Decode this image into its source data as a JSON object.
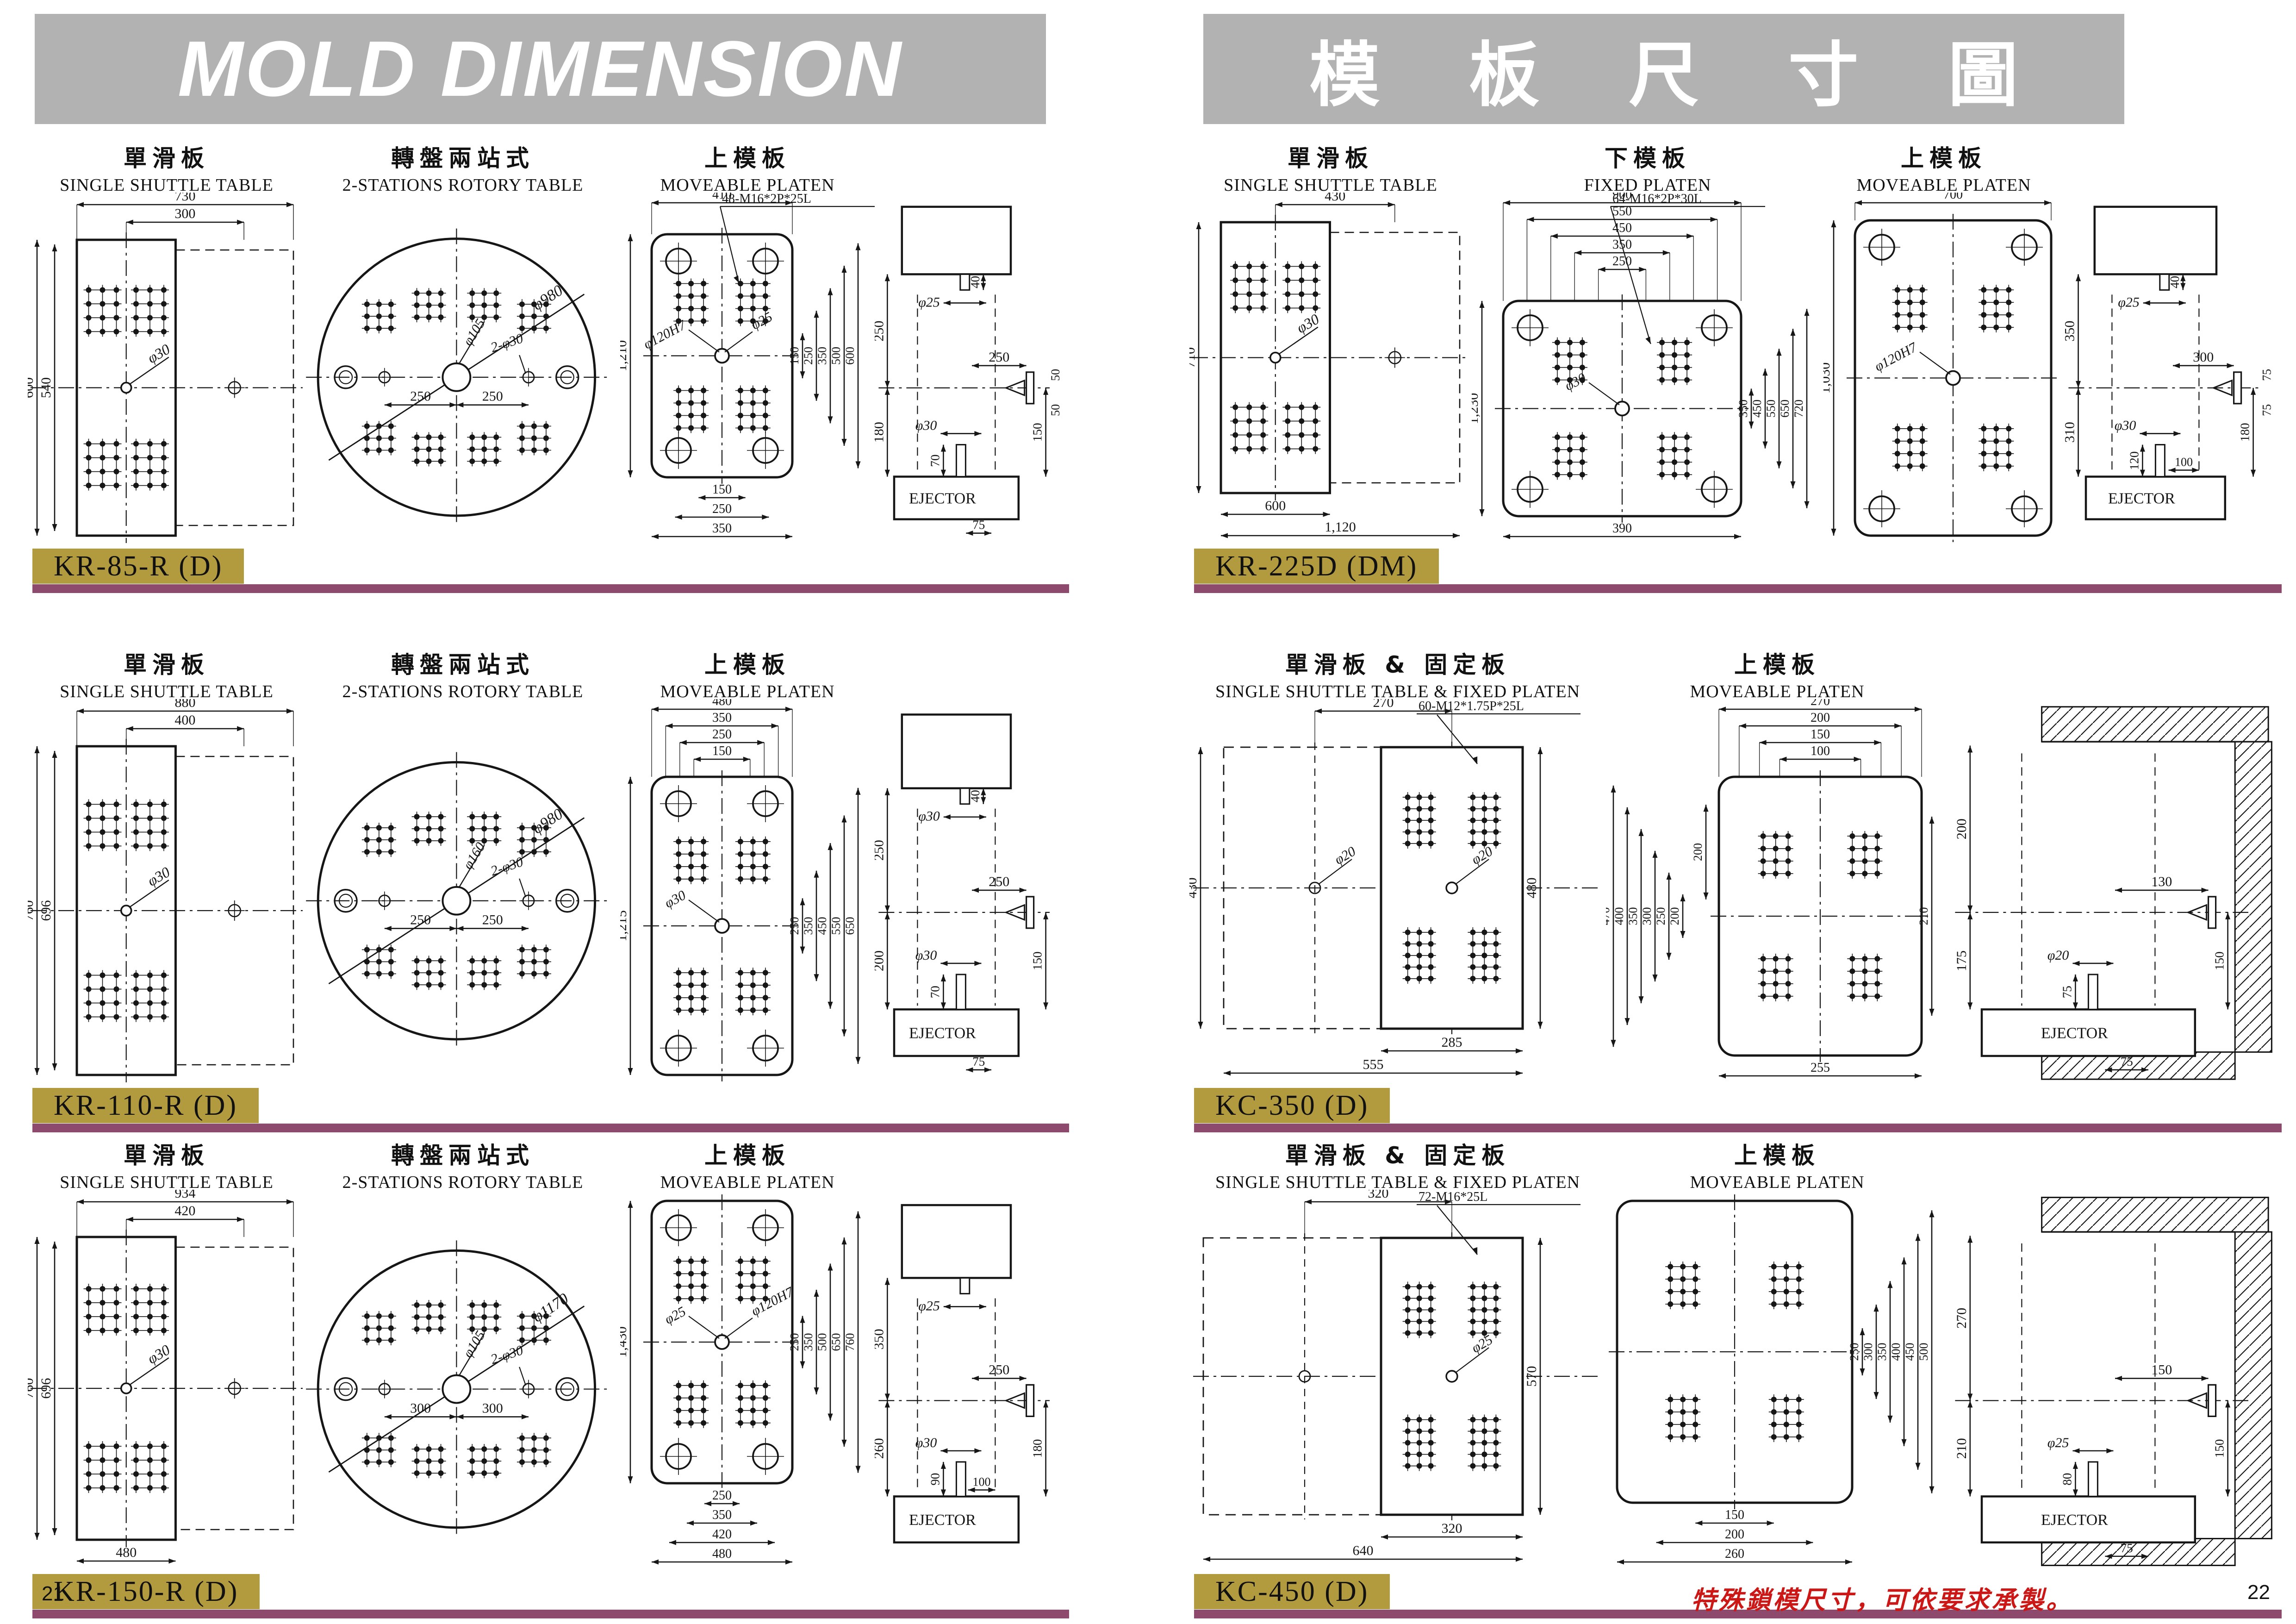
{
  "titles": {
    "left": "MOLD DIMENSION",
    "right": "模 板 尺 寸 圖"
  },
  "footer": {
    "left_page": "21",
    "right_page": "22",
    "note": "特殊鎖模尺寸，可依要求承製。"
  },
  "colors": {
    "header_bg": "#b2b2b2",
    "badge_bg": "#b29a3e",
    "bar": "#8d4a6d",
    "note_red": "#cc1717",
    "ink": "#161616"
  },
  "sections": [
    {
      "model": "KR-85-R (D)",
      "columns": [
        {
          "zh": "單滑板",
          "en": "SINGLE SHUTTLE TABLE"
        },
        {
          "zh": "轉盤兩站式",
          "en": "2-STATIONS ROTORY TABLE"
        },
        {
          "zh": "上模板",
          "en": "MOVEABLE PLATEN"
        }
      ],
      "drawings": [
        {
          "kind": "shuttle",
          "top": [
            "730",
            "300"
          ],
          "left": [
            "600",
            "540"
          ],
          "bottom": [],
          "center": "φ30"
        },
        {
          "kind": "rotary",
          "diameter": "φ980",
          "center": "φ105",
          "holes": "2-φ30",
          "spacing": [
            "250",
            "250"
          ]
        },
        {
          "kind": "platen",
          "top": [
            "410"
          ],
          "note": "48-M16*2P*25L",
          "height": "1,210",
          "center": [
            "φ120H7",
            "φ25"
          ],
          "right": [
            "150",
            "250",
            "350",
            "500",
            "600"
          ],
          "bottom": [
            "150",
            "250",
            "350"
          ]
        },
        {
          "kind": "side",
          "top": "40",
          "stem_top": "φ25",
          "left_top": "250",
          "left_bottom": "180",
          "stem_bottom": "φ30",
          "stem_h": "70",
          "nozzle_x": "250",
          "nozzle_y": "150",
          "pair": [
            "50",
            "50"
          ],
          "ejector": "EJECTOR",
          "foot": "75"
        }
      ]
    },
    {
      "model": "KR-110-R (D)",
      "columns": [
        {
          "zh": "單滑板",
          "en": "SINGLE SHUTTLE TABLE"
        },
        {
          "zh": "轉盤兩站式",
          "en": "2-STATIONS ROTORY TABLE"
        },
        {
          "zh": "上模板",
          "en": "MOVEABLE PLATEN"
        }
      ],
      "drawings": [
        {
          "kind": "shuttle",
          "top": [
            "880",
            "400"
          ],
          "left": [
            "760",
            "696"
          ],
          "bottom": [],
          "center": "φ30"
        },
        {
          "kind": "rotary",
          "diameter": "φ980",
          "center": "φ160",
          "holes": "2-φ30",
          "spacing": [
            "250",
            "250"
          ]
        },
        {
          "kind": "platen",
          "top": [
            "480",
            "350",
            "250",
            "150"
          ],
          "height": "1,215",
          "center": [
            "φ30"
          ],
          "right": [
            "250",
            "350",
            "450",
            "550",
            "650"
          ],
          "bottom": []
        },
        {
          "kind": "side",
          "top": "40",
          "stem_top": "φ30",
          "left_top": "250",
          "left_bottom": "200",
          "stem_bottom": "φ30",
          "stem_h": "70",
          "nozzle_x": "250",
          "nozzle_y": "150",
          "ejector": "EJECTOR",
          "foot": "75"
        }
      ]
    },
    {
      "model": "KR-150-R (D)",
      "columns": [
        {
          "zh": "單滑板",
          "en": "SINGLE SHUTTLE TABLE"
        },
        {
          "zh": "轉盤兩站式",
          "en": "2-STATIONS ROTORY TABLE"
        },
        {
          "zh": "上模板",
          "en": "MOVEABLE PLATEN"
        }
      ],
      "drawings": [
        {
          "kind": "shuttle",
          "top": [
            "934",
            "420"
          ],
          "left": [
            "760",
            "696"
          ],
          "bottom": [
            "480"
          ],
          "center": "φ30"
        },
        {
          "kind": "rotary",
          "diameter": "φ1170",
          "center": "φ105",
          "holes": "2-φ30",
          "spacing": [
            "300",
            "300"
          ]
        },
        {
          "kind": "platen",
          "top": [],
          "height": "1,430",
          "center": [
            "φ25",
            "φ120H7"
          ],
          "right": [
            "250",
            "350",
            "500",
            "650",
            "760"
          ],
          "bottom": [
            "250",
            "350",
            "420",
            "480"
          ]
        },
        {
          "kind": "side",
          "stem_top": "φ25",
          "left_top": "350",
          "left_bottom": "260",
          "stem_bottom": "φ30",
          "stem_h": "90",
          "inner": "100",
          "nozzle_x": "250",
          "nozzle_y": "180",
          "ejector": "EJECTOR"
        }
      ]
    },
    {
      "model": "KR-225D (DM)",
      "columns": [
        {
          "zh": "單滑板",
          "en": "SINGLE SHUTTLE TABLE"
        },
        {
          "zh": "下模板",
          "en": "FIXED PLATEN"
        },
        {
          "zh": "上模板",
          "en": "MOVEABLE PLATEN"
        }
      ],
      "drawings": [
        {
          "kind": "shuttle",
          "top": [
            "430"
          ],
          "left": [
            "710"
          ],
          "bottom": [
            "600",
            "1,120"
          ],
          "center": "φ30"
        },
        {
          "kind": "platen",
          "top": [
            "900",
            "550",
            "450",
            "350",
            "250"
          ],
          "note": "64-M16*2P*30L",
          "height": "1,230",
          "center": [
            "φ30"
          ],
          "right": [
            "350",
            "450",
            "550",
            "650",
            "720"
          ],
          "bottom": [
            "390"
          ]
        },
        {
          "kind": "platen",
          "top": [
            "700"
          ],
          "height": "1,030",
          "center": [
            "φ120H7"
          ],
          "right": [],
          "bottom": []
        },
        {
          "kind": "side",
          "top": "40",
          "stem_top": "φ25",
          "left_top": "350",
          "left_bottom": "310",
          "stem_bottom": "φ30",
          "stem_h": "120",
          "inner": "100",
          "nozzle_x": "300",
          "nozzle_y": "180",
          "pair": [
            "75",
            "75"
          ],
          "ejector": "EJECTOR"
        }
      ]
    },
    {
      "model": "KC-350 (D)",
      "columns": [
        {
          "zh": "單滑板 & 固定板",
          "en": "SINGLE SHUTTLE TABLE & FIXED PLATEN"
        },
        {
          "zh": "上模板",
          "en": "MOVEABLE PLATEN"
        }
      ],
      "drawings": [
        {
          "kind": "combined",
          "top": [
            "270"
          ],
          "note": "60-M12*1.75P*25L",
          "left": [
            "430"
          ],
          "right": [
            "480"
          ],
          "bottom": [
            "285",
            "555"
          ],
          "centers": [
            "φ20",
            "φ20"
          ]
        },
        {
          "kind": "platen",
          "corners": false,
          "top": [
            "270",
            "200",
            "150",
            "100"
          ],
          "left_stack": [
            "470",
            "400",
            "350",
            "300",
            "250",
            "200"
          ],
          "left": [
            "200"
          ],
          "right": [
            "210"
          ],
          "bottom": [
            "255"
          ],
          "center": []
        },
        {
          "kind": "side",
          "hatched": true,
          "left_top": "200",
          "left_bottom": "175",
          "stem_bottom": "φ20",
          "stem_h": "75",
          "nozzle_x": "130",
          "nozzle_y": "150",
          "ejector": "EJECTOR",
          "foot": "75"
        }
      ]
    },
    {
      "model": "KC-450 (D)",
      "columns": [
        {
          "zh": "單滑板 & 固定板",
          "en": "SINGLE SHUTTLE TABLE & FIXED PLATEN"
        },
        {
          "zh": "上模板",
          "en": "MOVEABLE PLATEN"
        }
      ],
      "drawings": [
        {
          "kind": "combined",
          "top": [
            "320"
          ],
          "note": "72-M16*25L",
          "right": [
            "570"
          ],
          "bottom": [
            "320",
            "640"
          ],
          "centers": [
            "φ25"
          ]
        },
        {
          "kind": "platen",
          "corners": false,
          "top": [],
          "right": [
            "250",
            "300",
            "350",
            "400",
            "450",
            "500"
          ],
          "bottom": [
            "150",
            "200",
            "260"
          ],
          "center": []
        },
        {
          "kind": "side",
          "hatched": true,
          "left_top": "270",
          "left_bottom": "210",
          "stem_bottom": "φ25",
          "stem_h": "80",
          "nozzle_x": "150",
          "nozzle_y": "150",
          "ejector": "EJECTOR",
          "foot": "75"
        }
      ]
    }
  ]
}
